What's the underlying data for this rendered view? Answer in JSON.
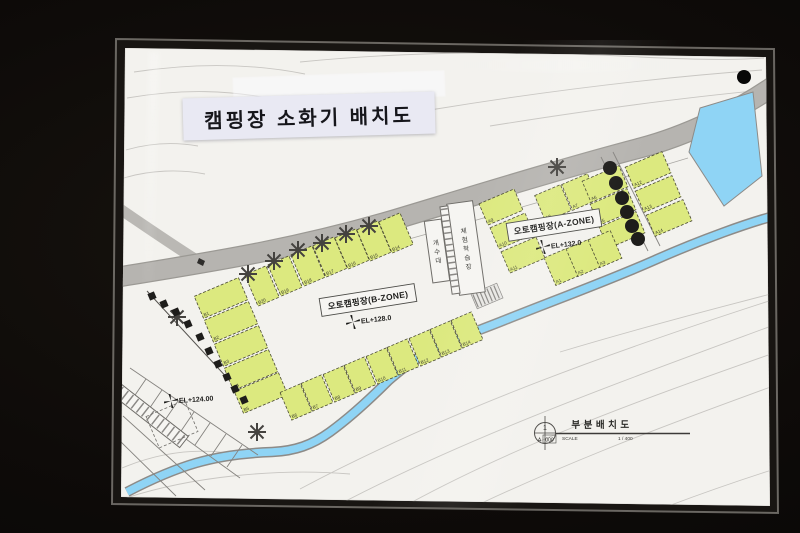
{
  "photo": {
    "width": 800,
    "height": 533
  },
  "colors": {
    "paper": "#f3f2ee",
    "label-bg": "#e9e9f3",
    "spot-fill": "#dce97f",
    "spot-stroke": "#4a4a32",
    "water": "#8fd4f5",
    "road": "#b6b4b0",
    "contour": "#c8c6c2",
    "line": "#85837f",
    "dark-tree": "#1e1d1b"
  },
  "title_label": {
    "text": "캠핑장 소화기 배치도"
  },
  "map": {
    "zone_a": {
      "label": "오토캠핑장(A-ZONE)",
      "elevation": "EL+132.0"
    },
    "zone_b": {
      "label": "오토캠핑장(B-ZONE)",
      "elevation": "EL+128.0"
    },
    "elevation_low": "EL+124.00",
    "buildings": [
      {
        "id": "sink",
        "name": "개수대",
        "x": 437,
        "y": 251,
        "w": 17,
        "h": 62,
        "angle": -8
      },
      {
        "id": "learning-hall",
        "name": "체험학습장",
        "x": 466,
        "y": 248,
        "w": 26,
        "h": 92,
        "angle": -8
      }
    ],
    "spot_groups": [
      {
        "id": "a-zone-top-row",
        "angle": -23,
        "w": 28,
        "h": 28,
        "spots": [
          {
            "label": "A8",
            "x": 553,
            "y": 203
          },
          {
            "label": "A7",
            "x": 580,
            "y": 192
          }
        ]
      },
      {
        "id": "a-zone-mid-column",
        "angle": -23,
        "w": 40,
        "h": 23,
        "spots": [
          {
            "label": "A6",
            "x": 605,
            "y": 184
          },
          {
            "label": "A5",
            "x": 613,
            "y": 207
          },
          {
            "label": "A4",
            "x": 622,
            "y": 230
          }
        ]
      },
      {
        "id": "a-zone-bottom-row",
        "angle": -23,
        "w": 24,
        "h": 30,
        "spots": [
          {
            "label": "A1",
            "x": 561,
            "y": 267
          },
          {
            "label": "A2",
            "x": 583,
            "y": 258
          },
          {
            "label": "A3",
            "x": 605,
            "y": 249
          }
        ]
      },
      {
        "id": "a-zone-left-column",
        "angle": -23,
        "w": 38,
        "h": 23,
        "spots": [
          {
            "label": "A9",
            "x": 501,
            "y": 207
          },
          {
            "label": "A10",
            "x": 512,
            "y": 231
          },
          {
            "label": "A11",
            "x": 523,
            "y": 255
          }
        ]
      },
      {
        "id": "a-zone-right-column",
        "angle": -23,
        "w": 40,
        "h": 23,
        "spots": [
          {
            "label": "A12",
            "x": 648,
            "y": 170
          },
          {
            "label": "A13",
            "x": 658,
            "y": 194
          },
          {
            "label": "A14",
            "x": 669,
            "y": 218
          }
        ]
      },
      {
        "id": "b-zone-top-row",
        "angle": -23,
        "w": 23,
        "h": 34,
        "spots": [
          {
            "label": "B20",
            "x": 262,
            "y": 286
          },
          {
            "label": "B19",
            "x": 285,
            "y": 276
          },
          {
            "label": "B18",
            "x": 308,
            "y": 266
          },
          {
            "label": "B17",
            "x": 330,
            "y": 257
          },
          {
            "label": "B16",
            "x": 352,
            "y": 249
          },
          {
            "label": "B15",
            "x": 374,
            "y": 241
          },
          {
            "label": "B14",
            "x": 396,
            "y": 233
          }
        ]
      },
      {
        "id": "b-zone-left-column",
        "angle": -23,
        "w": 48,
        "h": 24,
        "spots": [
          {
            "label": "B1",
            "x": 221,
            "y": 298
          },
          {
            "label": "B2",
            "x": 231,
            "y": 322
          },
          {
            "label": "B3",
            "x": 241,
            "y": 346
          },
          {
            "label": "B4",
            "x": 251,
            "y": 370
          },
          {
            "label": "B5",
            "x": 261,
            "y": 393
          }
        ]
      },
      {
        "id": "b-zone-bottom-row",
        "angle": -23,
        "w": 22,
        "h": 30,
        "spots": [
          {
            "label": "B6",
            "x": 296,
            "y": 402
          },
          {
            "label": "B7",
            "x": 317,
            "y": 393
          },
          {
            "label": "B8",
            "x": 339,
            "y": 384
          },
          {
            "label": "B9",
            "x": 360,
            "y": 375
          },
          {
            "label": "B10",
            "x": 382,
            "y": 366
          },
          {
            "label": "B11",
            "x": 403,
            "y": 357
          },
          {
            "label": "B12",
            "x": 425,
            "y": 348
          },
          {
            "label": "B13",
            "x": 446,
            "y": 339
          },
          {
            "label": "B14",
            "x": 467,
            "y": 330
          }
        ]
      }
    ],
    "trees": {
      "flower": [
        [
          177,
          317
        ],
        [
          248,
          274
        ],
        [
          274,
          261
        ],
        [
          298,
          250
        ],
        [
          322,
          243
        ],
        [
          346,
          234
        ],
        [
          369,
          226
        ],
        [
          257,
          432
        ],
        [
          557,
          167
        ]
      ],
      "dark_circles": [
        [
          610,
          168
        ],
        [
          616,
          183
        ],
        [
          622,
          198
        ],
        [
          627,
          212
        ],
        [
          632,
          226
        ],
        [
          638,
          239
        ]
      ],
      "dark_squares": [
        [
          152,
          296
        ],
        [
          164,
          304
        ],
        [
          176,
          312
        ],
        [
          188,
          324
        ],
        [
          200,
          337
        ],
        [
          209,
          351
        ],
        [
          218,
          364
        ],
        [
          227,
          377
        ],
        [
          235,
          389
        ],
        [
          244,
          400
        ]
      ]
    },
    "title_block": {
      "number": "1",
      "code_letter": "A",
      "code_number": "000",
      "title": "부분배치도",
      "scale_label": "SCALE",
      "scale_value": "1 / 400"
    }
  }
}
